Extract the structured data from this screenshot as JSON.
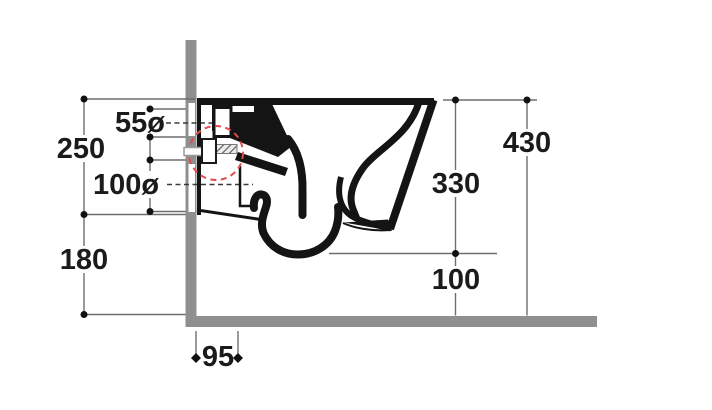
{
  "diagram": {
    "title": "wall-hung-toilet-installation-drawing",
    "units": "mm",
    "dims": [
      {
        "id": "back-panel-upper-height",
        "label": "250"
      },
      {
        "id": "flush-inlet-diameter",
        "label": "55ø"
      },
      {
        "id": "waste-outlet-diameter",
        "label": "100ø"
      },
      {
        "id": "back-panel-lower-height",
        "label": "180"
      },
      {
        "id": "wall-to-outlet-axis",
        "label": "95"
      },
      {
        "id": "rim-to-bowl-underside",
        "label": "330"
      },
      {
        "id": "bowl-underside-to-floor",
        "label": "100"
      },
      {
        "id": "floor-to-rim-height",
        "label": "430"
      }
    ],
    "colors": {
      "structure_gray": "#8f8f8f",
      "drawing_black": "#141414",
      "dimension_line": "#6e6e6e",
      "highlight_red": "#e14b50",
      "background": "#ffffff"
    }
  }
}
